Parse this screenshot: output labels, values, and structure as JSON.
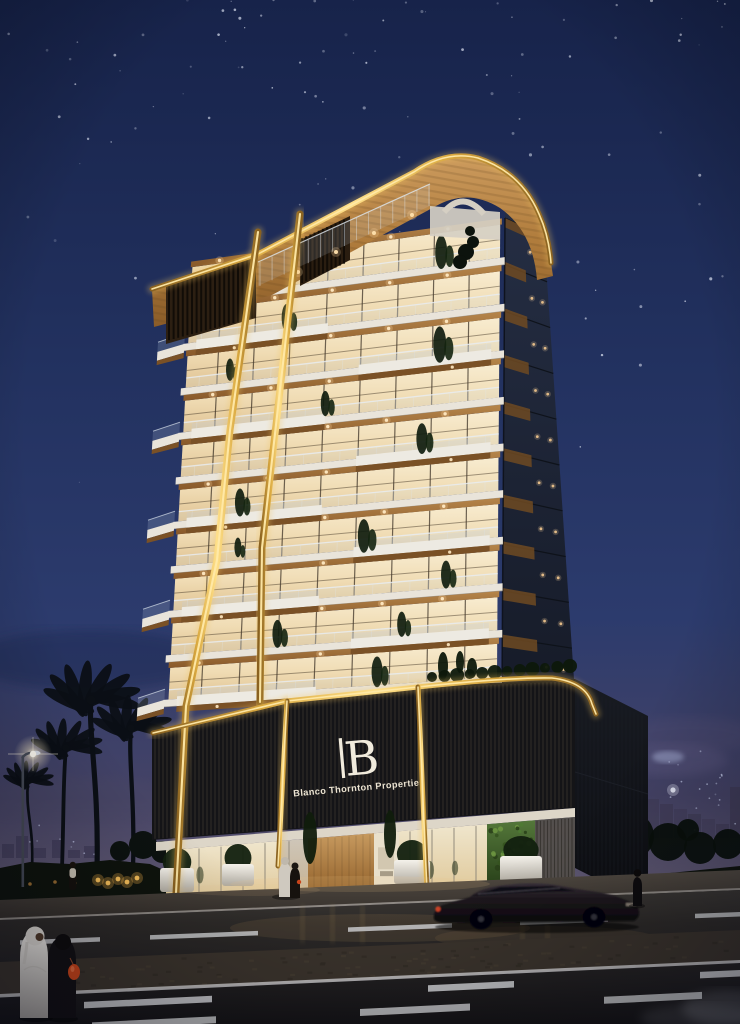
{
  "image": {
    "description": "Night-time architectural rendering of a luxury residential tower with warmly lit glass balconies, golden LED accent frames, a dark slatted podium with illuminated brand signage, palm trees, a street lamp, a passing car and pedestrians in abayas on the road in front",
    "setting": "night"
  },
  "branding": {
    "monogram": "B",
    "company_name": "Blanco Thornton Properties"
  },
  "building": {
    "balcony_floor_count": 10
  },
  "palette": {
    "sky_top": "#17234a",
    "sky_mid": "#22315f",
    "sky_low": "#2c3b6d",
    "horizon_haze": "#5c5571",
    "gold": "#f0c35e",
    "gold_bright": "#ffe9a8",
    "gold_deep": "#8a6220",
    "wood": "#a97a40",
    "wood_dark": "#7a5126",
    "crown_wood": "#b5854a",
    "glass_warm": "#f2ddb2",
    "slab_white": "#e9e4da",
    "podium_dark": "#141417",
    "side_face": "#1d2534",
    "wall_dark": "#13151b",
    "canopy": "#ddd6c8",
    "door_wood": "#b08449",
    "green_wall": "#42612e",
    "lobby_warm": "#f3e6c4",
    "road_dark": "#232122",
    "lane_mark": "#d6d7da",
    "median": "#3a332c",
    "sidewalk": "#443e38",
    "hedge": "#0e130d",
    "palm": "#0b0f15",
    "skyline": "#3d3856",
    "downlight": "#ffd9a0",
    "car_body": "#1d171c",
    "abaya_white": "#e6e3de",
    "abaya_black": "#121013",
    "handbag_red": "#c8441a",
    "lamp_light": "#fff4d6"
  }
}
